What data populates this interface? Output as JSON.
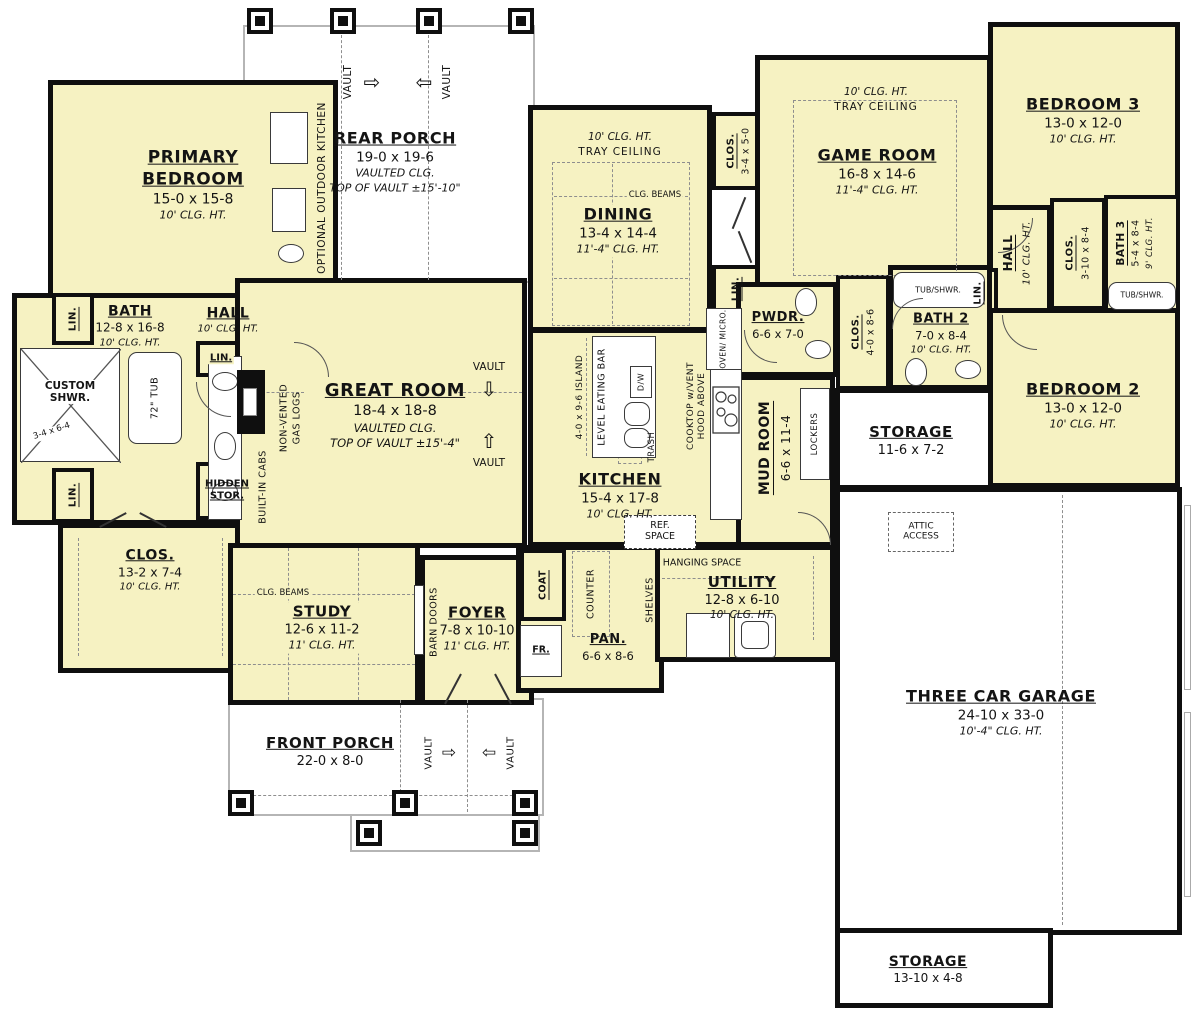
{
  "colors": {
    "room_fill": "#F6F2C2",
    "wall": "#0f0f0f",
    "porch_border": "#b5b5b5",
    "dash": "#8e8e8e"
  },
  "rooms": {
    "primary_bedroom": {
      "name": "PRIMARY BEDROOM",
      "dim": "15-0 x 15-8",
      "clg": "10' CLG. HT."
    },
    "bath": {
      "name": "BATH",
      "dim": "12-8 x 16-8",
      "clg": "10' CLG. HT."
    },
    "hall_left": {
      "name": "HALL",
      "clg": "10' CLG. HT."
    },
    "custom_shwr": {
      "name": "CUSTOM SHWR.",
      "dim": "3-4 x 6-4"
    },
    "tub": {
      "name": "72\" TUB"
    },
    "clos_primary": {
      "name": "CLOS.",
      "dim": "13-2 x 7-4",
      "clg": "10' CLG. HT."
    },
    "great_room": {
      "name": "GREAT ROOM",
      "dim": "18-4 x 18-8",
      "clg": "VAULTED CLG.",
      "extra": "TOP OF VAULT ±15'-4\""
    },
    "rear_porch": {
      "name": "REAR PORCH",
      "dim": "19-0 x 19-6",
      "clg": "VAULTED CLG.",
      "extra": "TOP OF VAULT ±15'-10\""
    },
    "front_porch": {
      "name": "FRONT PORCH",
      "dim": "22-0 x 8-0"
    },
    "dining": {
      "name": "DINING",
      "dim": "13-4 x 14-4",
      "clg": "11'-4\" CLG. HT.",
      "tray_clg": "10' CLG. HT.",
      "tray": "TRAY CEILING"
    },
    "kitchen": {
      "name": "KITCHEN",
      "dim": "15-4 x 17-8",
      "clg": "10' CLG. HT."
    },
    "game_room": {
      "name": "GAME ROOM",
      "dim": "16-8 x 14-6",
      "clg": "11'-4\" CLG. HT.",
      "tray_clg": "10' CLG. HT.",
      "tray": "TRAY CEILING"
    },
    "bedroom3": {
      "name": "BEDROOM 3",
      "dim": "13-0 x 12-0",
      "clg": "10' CLG. HT."
    },
    "hall_right": {
      "name": "HALL",
      "clg": "10' CLG. HT."
    },
    "clos_bed3": {
      "name": "CLOS.",
      "dim": "3-10 x 8-4"
    },
    "bath3": {
      "name": "BATH 3",
      "dim": "5-4 x 8-4",
      "clg": "9' CLG. HT."
    },
    "bedroom2": {
      "name": "BEDROOM 2",
      "dim": "13-0 x 12-0",
      "clg": "10' CLG. HT."
    },
    "bath2": {
      "name": "BATH 2",
      "dim": "7-0 x 8-4",
      "clg": "10' CLG. HT."
    },
    "clos_bed2": {
      "name": "CLOS.",
      "dim": "4-0 x 8-6"
    },
    "pwdr": {
      "name": "PWDR.",
      "dim": "6-6 x 7-0"
    },
    "mud_room": {
      "name": "MUD ROOM",
      "dim": "6-6 x 11-4"
    },
    "storage_side": {
      "name": "STORAGE",
      "dim": "11-6 x 7-2"
    },
    "garage": {
      "name": "THREE CAR GARAGE",
      "dim": "24-10 x 33-0",
      "clg": "10'-4\" CLG. HT."
    },
    "storage_bottom": {
      "name": "STORAGE",
      "dim": "13-10 x 4-8"
    },
    "utility": {
      "name": "UTILITY",
      "dim": "12-8 x 6-10",
      "clg": "10' CLG. HT."
    },
    "pan": {
      "name": "PAN.",
      "dim": "6-6 x 8-6"
    },
    "study": {
      "name": "STUDY",
      "dim": "12-6 x 11-2",
      "clg": "11' CLG. HT."
    },
    "foyer": {
      "name": "FOYER",
      "dim": "7-8 x 10-10",
      "clg": "11' CLG. HT."
    },
    "clos_dining": {
      "name": "CLOS.",
      "dim": "3-4 x 5-0"
    },
    "lin": {
      "name": "LIN."
    },
    "hidden_stor": {
      "name": "HIDDEN STOR."
    }
  },
  "labels": {
    "built_in_cabs": "BUILT-IN CABS",
    "non_vented_1": "NON-VENTED",
    "non_vented_2": "GAS LOGS",
    "optional_outdoor_kitchen": "OPTIONAL OUTDOOR KITCHEN",
    "vault": "VAULT",
    "island_dim": "4-0 x 9-6 ISLAND",
    "eating_bar": "LEVEL EATING BAR",
    "dw": "D/W",
    "trash": "TRASH",
    "cooktop_1": "COOKTOP w/VENT",
    "cooktop_2": "HOOD ABOVE",
    "oven_micro": "OVEN/ MICRO.",
    "ref_space": "REF. SPACE",
    "lockers": "LOCKERS",
    "tub_shwr": "TUB/SHWR.",
    "attic_access": "ATTIC ACCESS",
    "hanging_space": "HANGING SPACE",
    "coat": "COAT",
    "counter": "COUNTER",
    "shelves": "SHELVES",
    "fr": "FR.",
    "barn_doors": "BARN DOORS",
    "clg_beams": "CLG. BEAMS"
  },
  "icons": {
    "arrow_left": "⇦",
    "arrow_right": "⇨",
    "arrow_up": "⇧",
    "arrow_down": "⇩"
  }
}
